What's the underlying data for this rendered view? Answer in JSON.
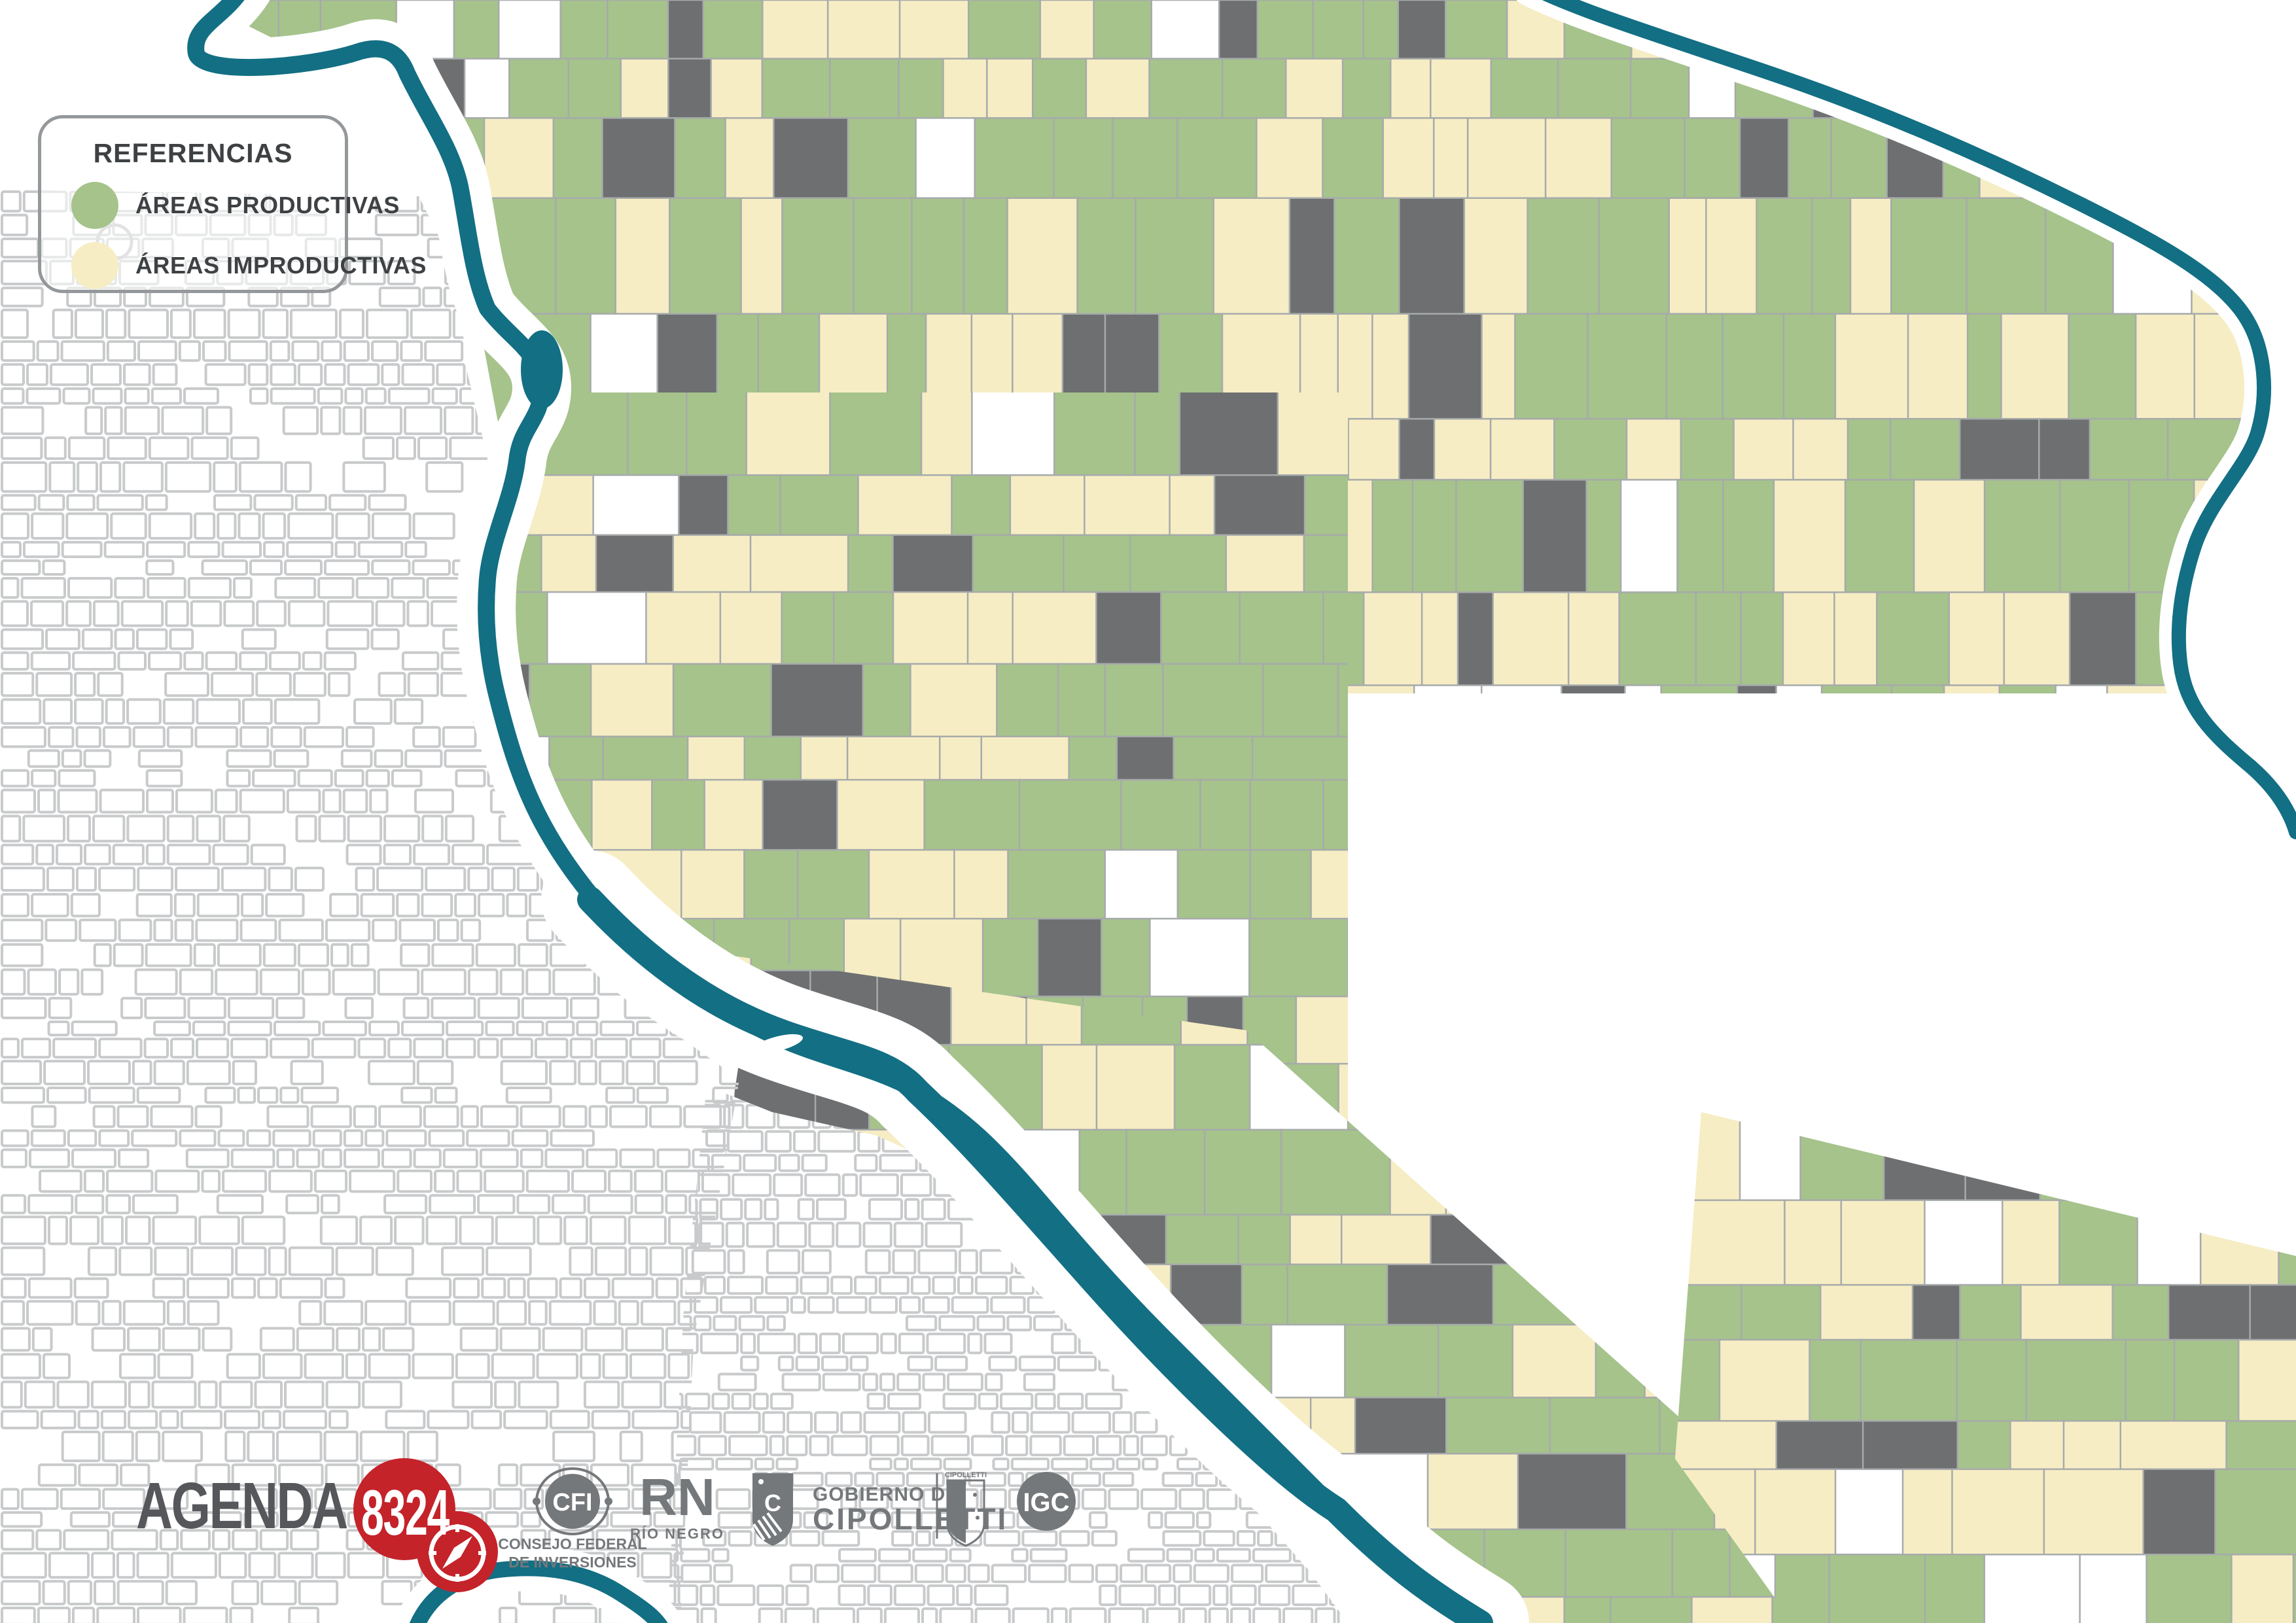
{
  "legend": {
    "title": "REFERENCIAS",
    "items": [
      {
        "label": "ÁREAS PRODUCTIVAS",
        "color": "#a5c38b"
      },
      {
        "label": "ÁREAS IMPRODUCTIVAS",
        "color": "#f6edc4"
      }
    ]
  },
  "footer": {
    "agenda": {
      "word": "AGENDA",
      "number": "8324"
    },
    "cfi": {
      "abbr": "CFI",
      "sub1": "CONSEJO FEDERAL",
      "sub2": "DE INVERSIONES"
    },
    "rn": {
      "abbr": "RN",
      "sub": "RÍO NEGRO"
    },
    "gobierno": {
      "line1": "GOBIERNO DE",
      "line2": "CIPOLLETTI",
      "shield_letter": "C",
      "crest_label": "CIPOLLETTI"
    },
    "igc": {
      "abbr": "IGC"
    }
  },
  "map": {
    "colors": {
      "productive": "#a5c38b",
      "improductive": "#f6edc4",
      "parcel_dark": "#6d6f71",
      "parcel_line": "#a7aaab",
      "river": "#136f83",
      "urban_block": "#5e5f62",
      "urban_rim": "#97989a",
      "park_green": "#93c06c",
      "road_black": "#1c1d1e",
      "road_dark": "#57585a",
      "road_gray": "#9a9d9f",
      "light_grid": "#c8cacb",
      "settlement": "#d8d9da",
      "boundary_red": "#e8212b",
      "logo_gray": "#75787b",
      "logo_red": "#c4232a",
      "text_dark": "#3e4144"
    }
  }
}
